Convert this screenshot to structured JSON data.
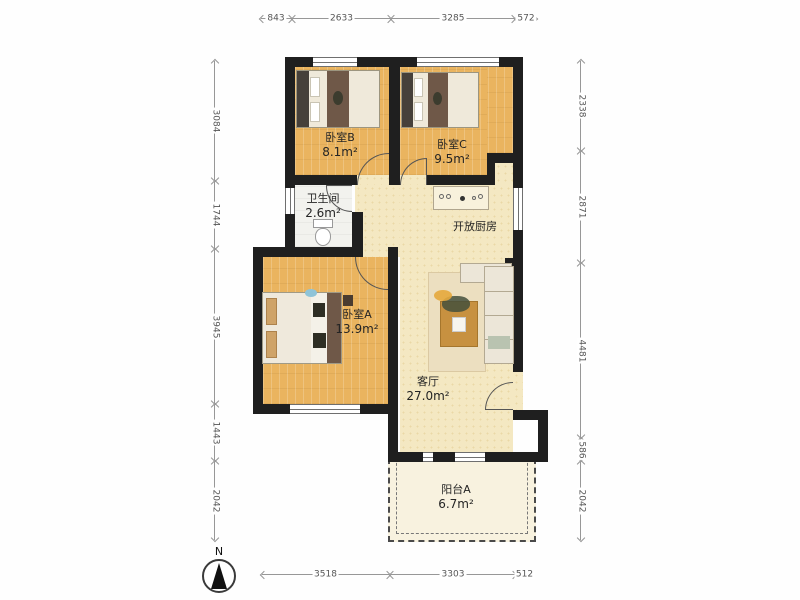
{
  "plan_title": "apartment-floor-plan",
  "dimensions": {
    "top": [
      "843",
      "2633",
      "3285",
      "572"
    ],
    "bottom": [
      "3518",
      "3303",
      "512"
    ],
    "left": [
      "3084",
      "1744",
      "3945",
      "1443",
      "2042"
    ],
    "right": [
      "2338",
      "2871",
      "4481",
      "586",
      "2042"
    ]
  },
  "rooms": {
    "bedroom_b": {
      "name": "卧室B",
      "area": "8.1m²"
    },
    "bedroom_c": {
      "name": "卧室C",
      "area": "9.5m²"
    },
    "bathroom": {
      "name": "卫生间",
      "area": "2.6m²"
    },
    "kitchen": {
      "name": "开放厨房"
    },
    "bedroom_a": {
      "name": "卧室A",
      "area": "13.9m²"
    },
    "living_room": {
      "name": "客厅",
      "area": "27.0m²"
    },
    "balcony": {
      "name": "阳台A",
      "area": "6.7m²"
    }
  },
  "compass": {
    "label": "N"
  },
  "colors": {
    "wall": "#1f1f1f",
    "wood_floor": "#eab45f",
    "open_floor": "#f4e8c2",
    "bath_floor": "#f2f2ee",
    "balcony_floor": "#f8f2df",
    "dimension_text": "#555555"
  }
}
